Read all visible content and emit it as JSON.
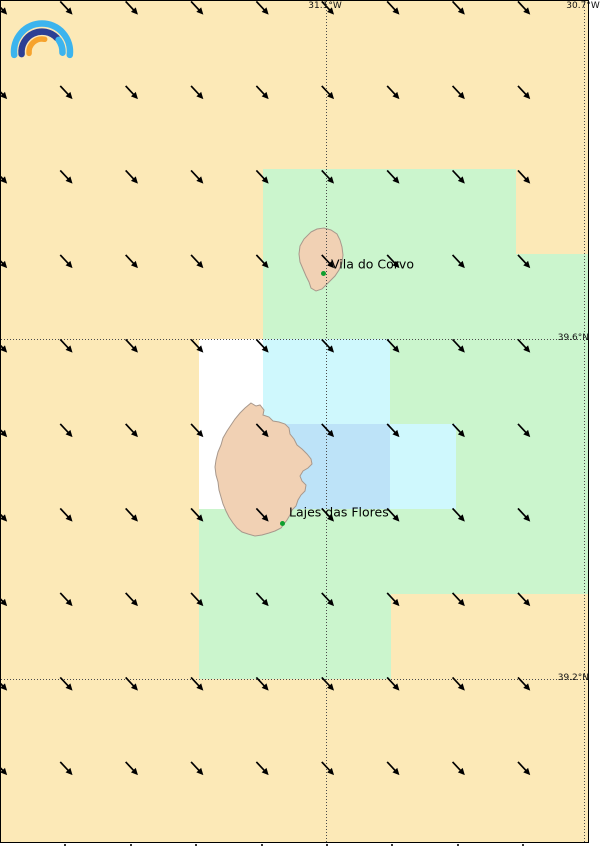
{
  "map": {
    "type": "wind-forecast-map",
    "colors": {
      "land_bg": "#fce9b7",
      "green": "#cbf5cd",
      "cyan": "#cff8fd",
      "blue": "#bde3f8",
      "white": "#ffffff",
      "island_fill": "#f1d1b4",
      "island_stroke": "#a8988c",
      "arrow": "#000000",
      "grid_line": "#4a4a4a",
      "border": "#000000",
      "town_dot": "#0f9f2f",
      "label_text": "#000000"
    },
    "frame": {
      "width": 589,
      "height": 843
    },
    "graticule": {
      "meridians": [
        {
          "x": 325,
          "label": "31.1°W"
        },
        {
          "x": 583,
          "label": "30.7°W"
        }
      ],
      "parallels": [
        {
          "y": 338,
          "label": "39.6°N"
        },
        {
          "y": 678,
          "label": "39.2°N"
        }
      ]
    },
    "cells": [
      {
        "x": 262,
        "y": 168,
        "w": 253,
        "h": 85,
        "color": "green"
      },
      {
        "x": 262,
        "y": 253,
        "w": 327,
        "h": 85,
        "color": "green"
      },
      {
        "x": 198,
        "y": 338,
        "w": 64,
        "h": 170,
        "color": "white"
      },
      {
        "x": 262,
        "y": 338,
        "w": 127,
        "h": 85,
        "color": "cyan"
      },
      {
        "x": 389,
        "y": 338,
        "w": 200,
        "h": 85,
        "color": "green"
      },
      {
        "x": 262,
        "y": 423,
        "w": 127,
        "h": 85,
        "color": "blue"
      },
      {
        "x": 389,
        "y": 423,
        "w": 66,
        "h": 85,
        "color": "cyan"
      },
      {
        "x": 455,
        "y": 423,
        "w": 134,
        "h": 85,
        "color": "green"
      },
      {
        "x": 198,
        "y": 508,
        "w": 391,
        "h": 85,
        "color": "green"
      },
      {
        "x": 198,
        "y": 593,
        "w": 192,
        "h": 85,
        "color": "green"
      }
    ],
    "wind": {
      "cols": [
        0,
        65.4,
        130.8,
        196.2,
        261.5,
        326.9,
        392.3,
        457.7,
        523.1
      ],
      "rows": [
        7,
        91.5,
        176,
        260.5,
        345,
        429.5,
        514,
        598.5,
        683,
        767.5
      ],
      "angle_deg": 47,
      "length": 18
    },
    "bottom_ticks_x": [
      65,
      131,
      196,
      262,
      327,
      392,
      458,
      523
    ],
    "towns": [
      {
        "name": "Vila do Corvo",
        "dot_x": 323,
        "dot_y": 273,
        "label_x": 331,
        "label_y": 264
      },
      {
        "name": "Lajes das Flores",
        "dot_x": 282,
        "dot_y": 523,
        "label_x": 289,
        "label_y": 512
      }
    ],
    "islands": [
      {
        "name": "Corvo",
        "path": "M310,231 L316,228 L323,227 L330,229 L336,233 L339,239 L341,246 L342,254 L341,262 L338,269 L334,275 L329,280 L325,284 L321,288 L315,290 L310,287 L308,281 L305,275 L302,268 L299,261 L298,253 L299,245 L303,238 Z"
      },
      {
        "name": "Flores",
        "path": "M250,402 L255,405 L259,404 L263,409 L262,414 L268,416 L272,420 L278,421 L284,423 L288,427 L289,433 L293,438 L296,444 L301,448 L306,453 L310,458 L311,463 L307,467 L302,470 L299,475 L301,480 L305,484 L304,490 L300,494 L297,499 L295,505 L291,509 L289,514 L286,519 L283,523 L280,527 L274,530 L268,532 L261,534 L254,535 L247,533 L241,531 L236,527 L232,522 L228,516 L225,510 L222,503 L220,496 L218,489 L217,481 L215,474 L214,466 L215,459 L217,451 L220,444 L222,437 L226,430 L230,424 L234,418 L239,412 L244,407 Z"
      }
    ]
  },
  "logo": {
    "name": "rainbow-arcs-logo",
    "light_blue": "#3cb4ee",
    "navy": "#2c3f94",
    "orange": "#f6a32e"
  }
}
